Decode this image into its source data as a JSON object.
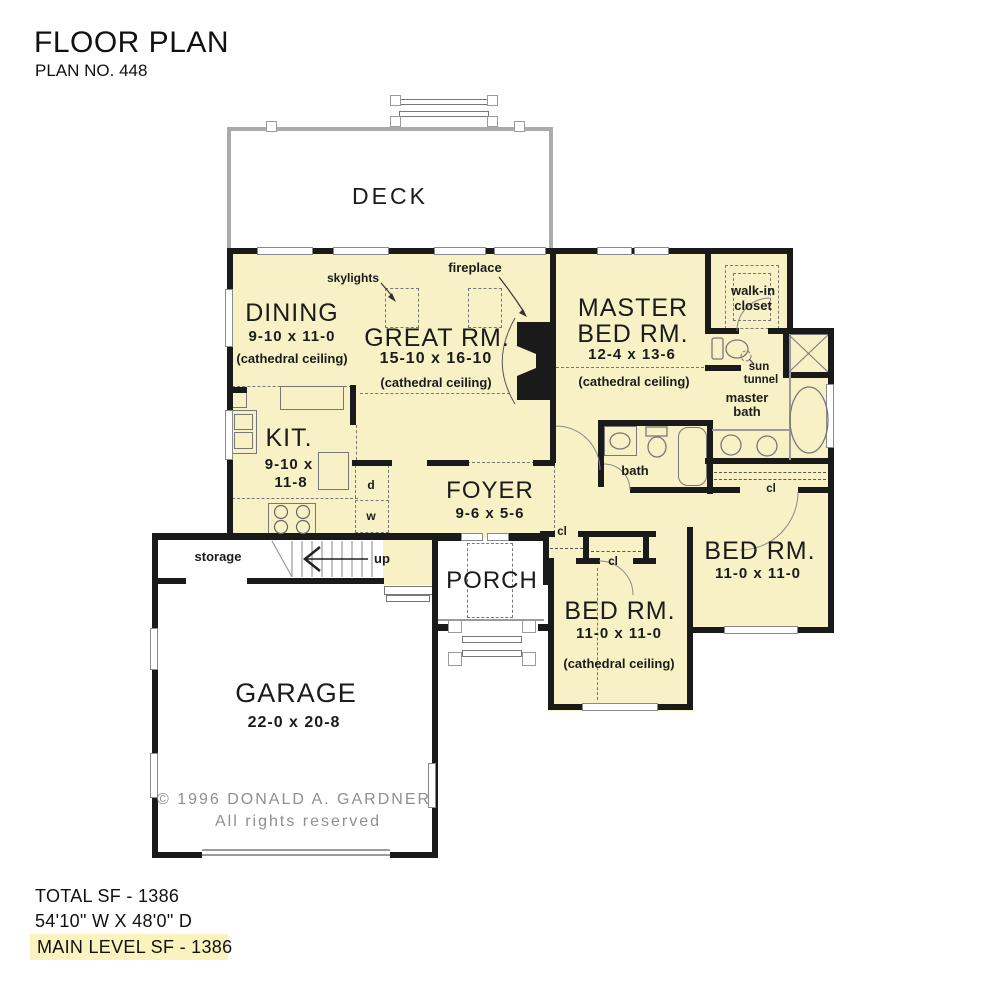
{
  "header": {
    "title": "FLOOR PLAN",
    "plan_no": "PLAN NO. 448"
  },
  "rooms": {
    "deck": {
      "name": "DECK"
    },
    "dining": {
      "name": "DINING",
      "dims": "9-10 x 11-0",
      "note": "(cathedral ceiling)"
    },
    "great": {
      "name": "GREAT RM.",
      "dims": "15-10 x 16-10",
      "note": "(cathedral ceiling)"
    },
    "master": {
      "name1": "MASTER",
      "name2": "BED RM.",
      "dims": "12-4 x 13-6",
      "note": "(cathedral ceiling)"
    },
    "kitchen": {
      "name": "KIT.",
      "dims1": "9-10 x",
      "dims2": "11-8"
    },
    "foyer": {
      "name": "FOYER",
      "dims": "9-6 x 5-6"
    },
    "porch": {
      "name": "PORCH"
    },
    "garage": {
      "name": "GARAGE",
      "dims": "22-0 x 20-8"
    },
    "bed2": {
      "name": "BED RM.",
      "dims": "11-0 x 11-0",
      "note": "(cathedral ceiling)"
    },
    "bed3": {
      "name": "BED RM.",
      "dims": "11-0 x 11-0"
    },
    "walkin": {
      "line1": "walk-in",
      "line2": "closet"
    },
    "masterbath": {
      "line1": "master",
      "line2": "bath"
    },
    "bath": {
      "name": "bath"
    },
    "storage": {
      "name": "storage"
    }
  },
  "annotations": {
    "skylights": "skylights",
    "fireplace": "fireplace",
    "sun1": "sun",
    "sun2": "tunnel",
    "up": "up",
    "d": "d",
    "w": "w",
    "cl": "cl"
  },
  "copyright": {
    "line1": "© 1996  DONALD  A.  GARDNER",
    "line2": "All  rights  reserved"
  },
  "summary": {
    "total": "TOTAL SF - 1386",
    "dims": "54'10\" W X 48'0\" D",
    "main_level": "MAIN LEVEL SF - 1386"
  },
  "colors": {
    "room_fill": "#F7F1C5",
    "wall": "#1a1a1a",
    "highlight": "#FAF3BE",
    "dash": "#777777",
    "gray_line": "#9a9a9a"
  }
}
